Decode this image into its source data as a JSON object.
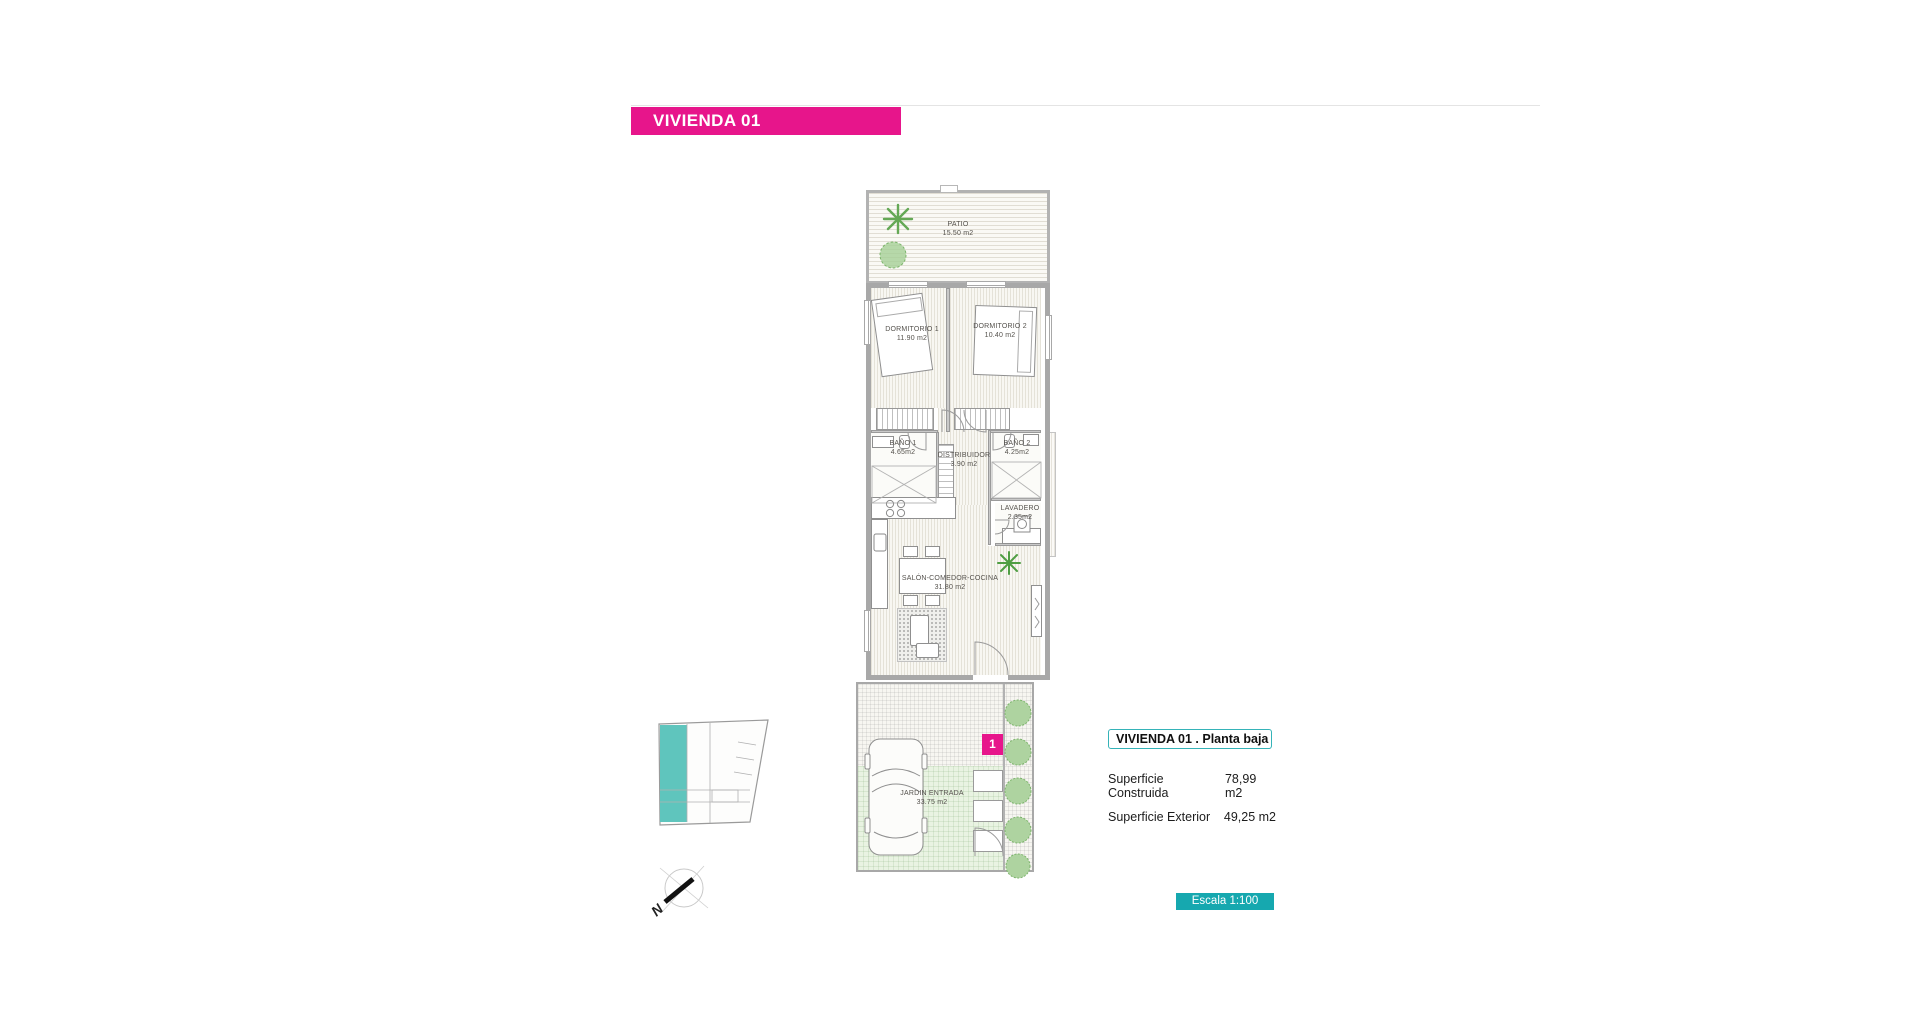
{
  "title_bar": {
    "label": "VIVIENDA 01"
  },
  "plan": {
    "rooms": [
      {
        "name": "PATIO",
        "area": "15.50 m2"
      },
      {
        "name": "DORMITORIO 1",
        "area": "11.90 m2"
      },
      {
        "name": "DORMITORIO 2",
        "area": "10.40 m2"
      },
      {
        "name": "BAÑO 1",
        "area": "4.65m2"
      },
      {
        "name": "DISTRIBUIDOR",
        "area": "3.90 m2"
      },
      {
        "name": "BAÑO 2",
        "area": "4.25m2"
      },
      {
        "name": "LAVADERO",
        "area": "2.35m2"
      },
      {
        "name": "SALÓN-COMEDOR-COCINA",
        "area": "31.80 m2"
      },
      {
        "name": "JARDIN ENTRADA",
        "area": "33.75 m2"
      }
    ],
    "unit_marker": "1",
    "compass_label": "N"
  },
  "info_panel": {
    "header": "VIVIENDA 01 .  Planta baja",
    "rows": [
      {
        "label": "Superficie Construida",
        "value": "78,99 m2"
      },
      {
        "label": "Superficie Exterior",
        "value": "49,25 m2"
      }
    ]
  },
  "scale_badge": {
    "label": "Escala 1:100"
  },
  "colors": {
    "pink": "#E7158B",
    "teal": "#16a8af",
    "teal_light": "#5fc5bd"
  }
}
